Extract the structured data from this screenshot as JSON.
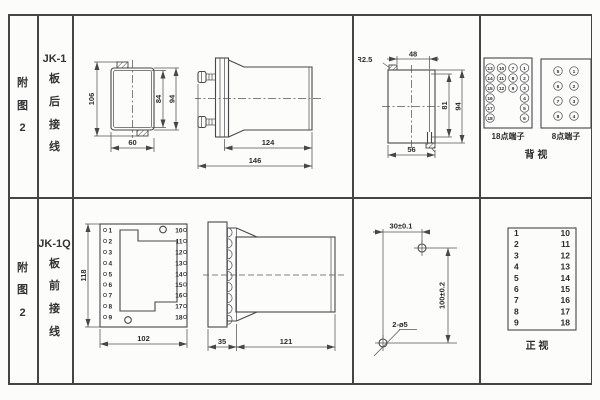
{
  "sidebar": {
    "row1": {
      "fig": "附图2",
      "model": "JK-1",
      "wiring": "板后接线"
    },
    "row2": {
      "fig": "附图2",
      "model": "JK-1Q",
      "wiring": "板前接线"
    }
  },
  "jk1": {
    "front": {
      "dim_total_h": "106",
      "dim_inner_h": "84",
      "dim_outer_h": "94",
      "dim_w": "60"
    },
    "side": {
      "dim_depth": "124",
      "dim_total": "146"
    },
    "cutout": {
      "radius_label": "2-R2.5",
      "dim_top": "48",
      "dim_inner_h": "81",
      "dim_h": "94",
      "dim_w": "56"
    },
    "rear": {
      "t18_label": "18点端子",
      "t8_label": "8点端子",
      "view_label": "背 视",
      "t18_col1": [
        "13",
        "14",
        "15",
        "16",
        "17",
        "18"
      ],
      "t18_col2": [
        "10",
        "11",
        "12"
      ],
      "t18_col3": [
        "7",
        "8",
        "9"
      ],
      "t18_col4": [
        "1",
        "2",
        "3",
        "4",
        "5",
        "6"
      ],
      "t8_col1": [
        "5",
        "6",
        "7",
        "8"
      ],
      "t8_col2": [
        "1",
        "2",
        "3",
        "4"
      ]
    }
  },
  "jk1q": {
    "front": {
      "dim_h": "118",
      "dim_w": "102",
      "left": [
        "1",
        "2",
        "3",
        "4",
        "5",
        "6",
        "7",
        "8",
        "9"
      ],
      "right": [
        "10",
        "11",
        "12",
        "13",
        "14",
        "15",
        "16",
        "17",
        "18"
      ]
    },
    "side": {
      "dim_plate": "35",
      "dim_depth": "121"
    },
    "drill": {
      "dim_h": "30±0.1",
      "dim_v": "100±0.2",
      "hole_label": "2-ø5"
    },
    "front_table": {
      "left": [
        "1",
        "2",
        "3",
        "4",
        "5",
        "6",
        "7",
        "8",
        "9"
      ],
      "right": [
        "10",
        "11",
        "12",
        "13",
        "14",
        "15",
        "16",
        "17",
        "18"
      ],
      "view_label": "正 视"
    }
  }
}
